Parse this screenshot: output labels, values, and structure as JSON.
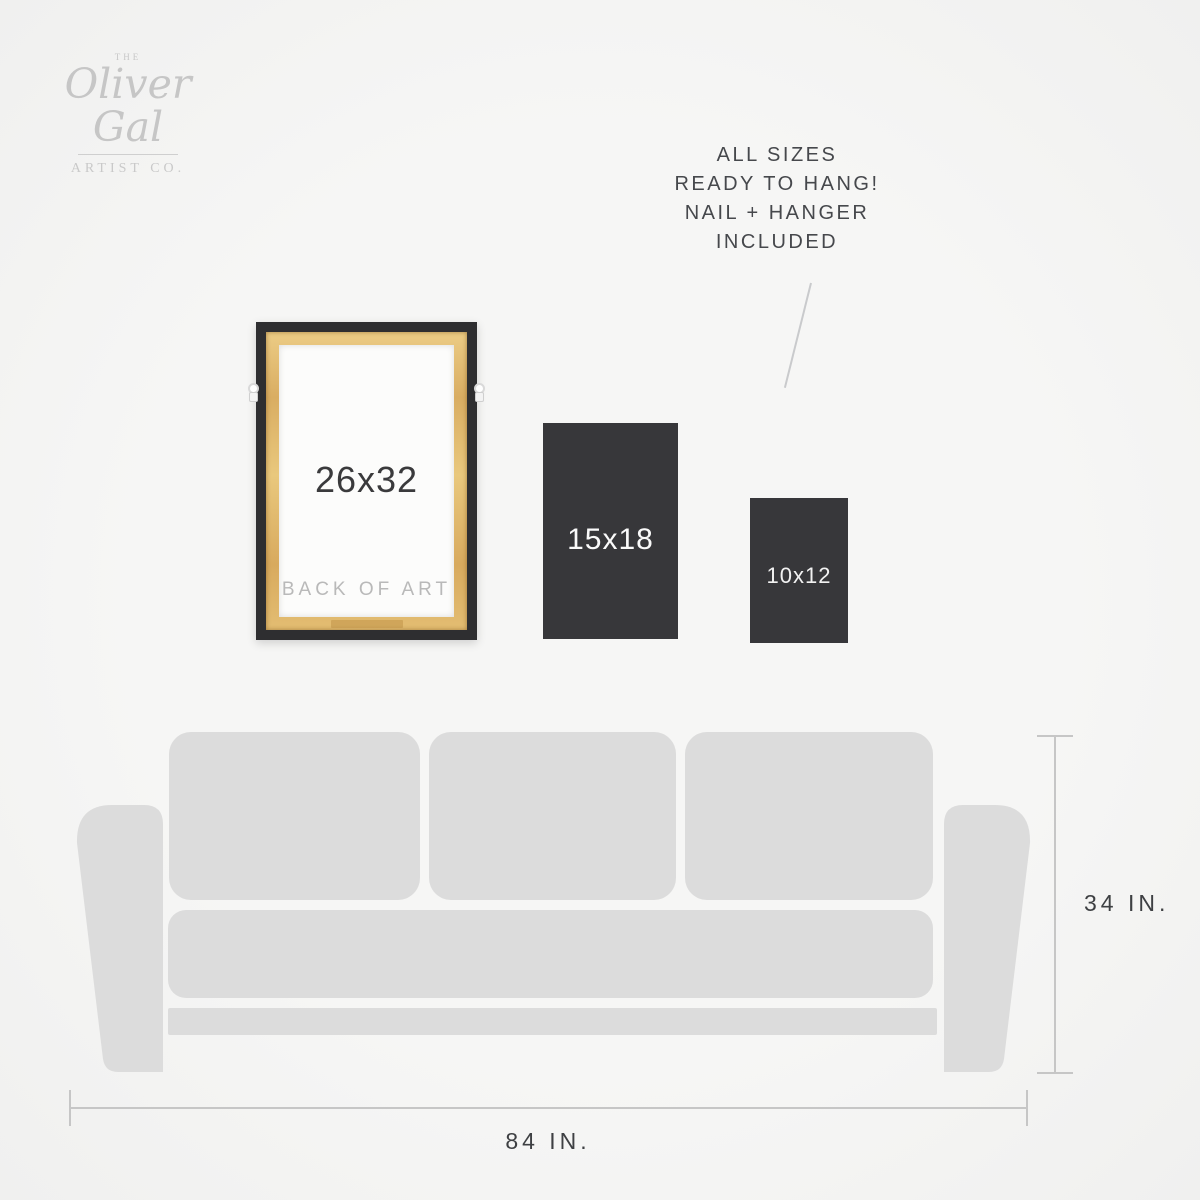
{
  "brand": {
    "the": "THE",
    "name": "Oliver Gal",
    "subtitle": "ARTIST CO."
  },
  "callout": {
    "lines": [
      "ALL SIZES",
      "READY TO HANG!",
      "NAIL + HANGER",
      "INCLUDED"
    ]
  },
  "frames": [
    {
      "label": "26x32",
      "note": "BACK OF ART",
      "style": "framed-back-of-art"
    },
    {
      "label": "15x18",
      "style": "dark-flat"
    },
    {
      "label": "10x12",
      "style": "dark-flat"
    }
  ],
  "sofa": {
    "height_label": "34 IN.",
    "width_label": "84 IN."
  },
  "colors": {
    "background": "#f5f5f4",
    "sofa_fill": "#dcdcdc",
    "frame_border_dark": "#2e2e30",
    "dark_block": "#37373a",
    "wood_light": "#eccc85",
    "wood_dark": "#d8aa5e",
    "dimension_line": "#c6c6c6",
    "text_dark": "#46484c",
    "text_muted": "#b9b9b9",
    "logo_gray": "#c7c7c7"
  }
}
